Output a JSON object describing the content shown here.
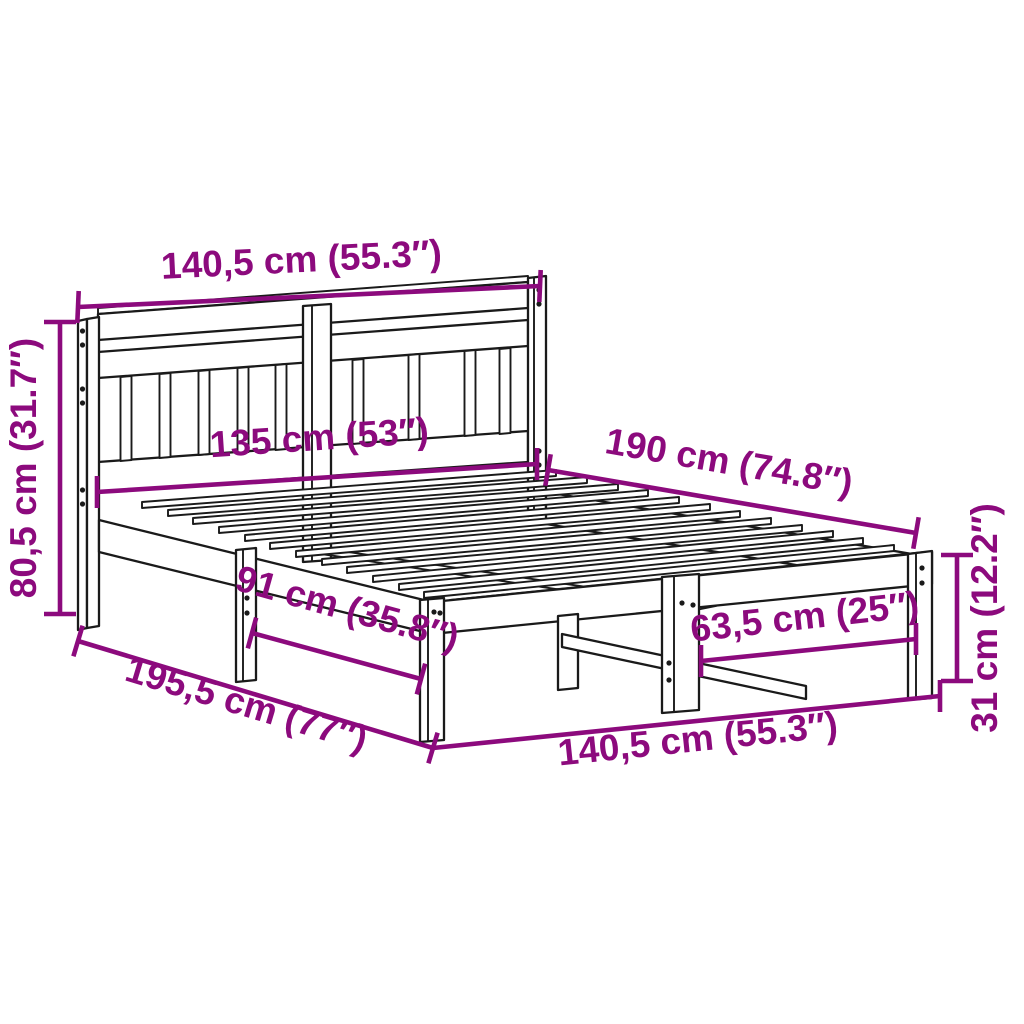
{
  "diagram": {
    "type": "product-dimension-diagram",
    "subject": "wooden-bed-frame-with-headboard",
    "colors": {
      "dimension_annotation": "#8C0A7D",
      "outline": "#1A1A1A",
      "background": "#FFFFFF"
    },
    "labels": {
      "headboard_width_top": "140,5 cm (55.3″)",
      "headboard_height": "80,5 cm (31.7″)",
      "headboard_inner_width": "135 cm (53″)",
      "bed_length": "190 cm (74.8″)",
      "left_leg_spacing": "91 cm (35.8″)",
      "right_leg_spacing": "63,5 cm (25″)",
      "total_length": "195,5 cm (77″)",
      "frame_width_bottom": "140,5 cm (55.3″)",
      "frame_height": "31 cm (12.2″)"
    }
  }
}
